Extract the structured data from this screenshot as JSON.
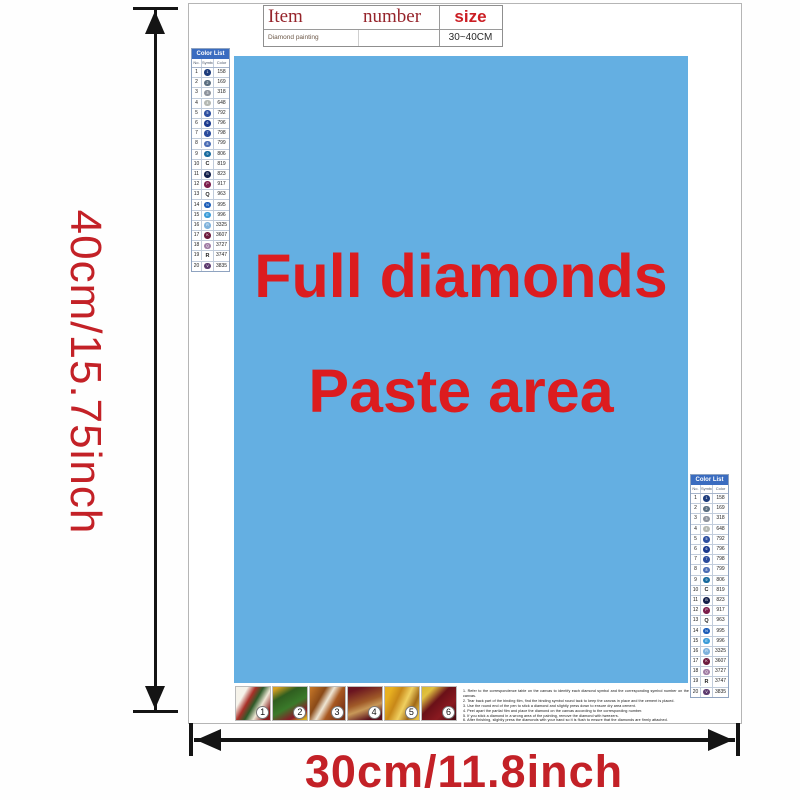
{
  "dimensions": {
    "height_label": "40cm/15.75inch",
    "width_label": "30cm/11.8inch"
  },
  "item_table": {
    "header": {
      "item": "Item",
      "number": "number",
      "size": "size"
    },
    "row": {
      "item": "Diamond painting",
      "number": "",
      "size": "30~40CM"
    }
  },
  "paste_area": {
    "line1": "Full diamonds",
    "line2": "Paste area",
    "bg_color": "#64afe2",
    "text_color": "#dc1c1f"
  },
  "color_list": {
    "title": "Color List",
    "columns": [
      "No.",
      "Symbol",
      "Color"
    ],
    "rows": [
      {
        "no": "1",
        "code": "158",
        "dot": "#1d3c7c",
        "sym": "1"
      },
      {
        "no": "2",
        "code": "169",
        "dot": "#5a6e80",
        "sym": "2"
      },
      {
        "no": "3",
        "code": "318",
        "dot": "#8d939c",
        "sym": "3"
      },
      {
        "no": "4",
        "code": "648",
        "dot": "#b4b8b2",
        "sym": "4"
      },
      {
        "no": "5",
        "code": "792",
        "dot": "#2d4fa0",
        "sym": "5"
      },
      {
        "no": "6",
        "code": "796",
        "dot": "#1b3a8e",
        "sym": "6"
      },
      {
        "no": "7",
        "code": "798",
        "dot": "#2a4b9c",
        "sym": "7"
      },
      {
        "no": "8",
        "code": "799",
        "dot": "#4a6cb4",
        "sym": "8"
      },
      {
        "no": "9",
        "code": "806",
        "dot": "#176a9e",
        "sym": "9"
      },
      {
        "no": "10",
        "code": "819",
        "letter": "C"
      },
      {
        "no": "11",
        "code": "823",
        "dot": "#131f4a",
        "sym": "B"
      },
      {
        "no": "12",
        "code": "917",
        "dot": "#7c1e4c",
        "sym": "P"
      },
      {
        "no": "13",
        "code": "963",
        "letter": "Q"
      },
      {
        "no": "14",
        "code": "995",
        "dot": "#1a5cb8",
        "sym": "N"
      },
      {
        "no": "15",
        "code": "996",
        "dot": "#3b9cd8",
        "sym": "E"
      },
      {
        "no": "16",
        "code": "3325",
        "dot": "#7fb2dc",
        "sym": "R"
      },
      {
        "no": "17",
        "code": "3607",
        "dot": "#6e1c3e",
        "sym": "K"
      },
      {
        "no": "18",
        "code": "3727",
        "dot": "#a07ca4",
        "sym": "Q"
      },
      {
        "no": "19",
        "code": "3747",
        "letter": "R"
      },
      {
        "no": "20",
        "code": "3835",
        "dot": "#5c3a6e",
        "sym": "V"
      }
    ]
  },
  "steps": {
    "numbers": [
      "1",
      "2",
      "3",
      "4",
      "5",
      "6"
    ]
  },
  "instructions": {
    "lines": [
      "1. Refer to the correspondence table on the canvas to identify each diamond symbol and the corresponding symbol number on the canvas.",
      "2. Tear back part of the binding film, find the binding symbol round tack to keep the canvas in place and the cement is placed.",
      "3. Use the round end of the pen to stick a diamond and slightly press down to ensure dry area cement.",
      "4. Peel apart the partial film and place the diamond on the canvas according to the corresponding number.",
      "5. If you stick a diamond in a wrong area of the painting, remove the diamond with tweezers.",
      "6. After finishing, slightly press the diamonds with your hand so it is flush to ensure that the diamonds are firmly attached."
    ]
  }
}
